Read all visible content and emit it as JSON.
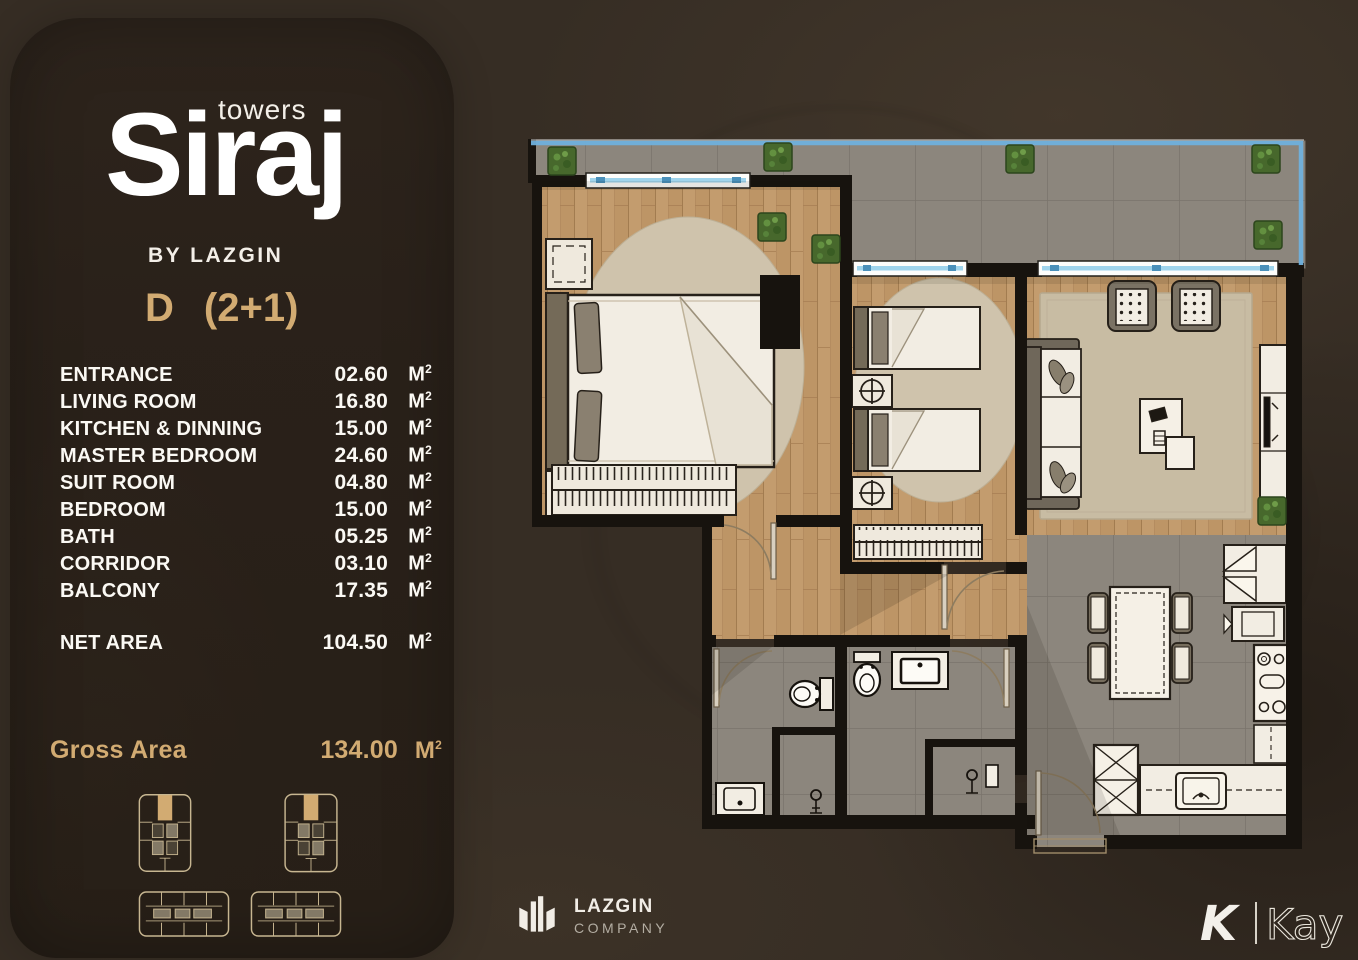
{
  "brand": {
    "towers_label": "towers",
    "name": "Siraj",
    "byline": "BY LAZGIN"
  },
  "unit": {
    "code": "D",
    "scheme": "(2+1)"
  },
  "area_unit": {
    "base": "M",
    "sup": "2"
  },
  "rooms": [
    {
      "label": "ENTRANCE",
      "value": "02.60"
    },
    {
      "label": "LIVING ROOM",
      "value": "16.80"
    },
    {
      "label": "KITCHEN & DINNING",
      "value": "15.00"
    },
    {
      "label": "MASTER BEDROOM",
      "value": "24.60"
    },
    {
      "label": "SUIT ROOM",
      "value": "04.80"
    },
    {
      "label": "BEDROOM",
      "value": "15.00"
    },
    {
      "label": "BATH",
      "value": "05.25"
    },
    {
      "label": "CORRIDOR",
      "value": "03.10"
    },
    {
      "label": "BALCONY",
      "value": "17.35"
    }
  ],
  "net": {
    "label": "NET AREA",
    "value": "104.50"
  },
  "gross": {
    "label": "Gross Area",
    "value": "134.00"
  },
  "footer": {
    "lazgin": {
      "name": "LAZGIN",
      "sub": "COMPANY"
    },
    "kay": {
      "initial": "K",
      "name": "Kay"
    }
  },
  "colors": {
    "accent": "#d2ab72",
    "background": "#362d24",
    "panel": "#2a211a",
    "wall": "#17130e",
    "wood_floor": "#c39c6e",
    "tile_floor": "#948e83",
    "window_glass": "#9fd4ec",
    "balustrade": "#6fb0dd",
    "plant_green": "#47682c",
    "rug": "#cfc3ac"
  }
}
